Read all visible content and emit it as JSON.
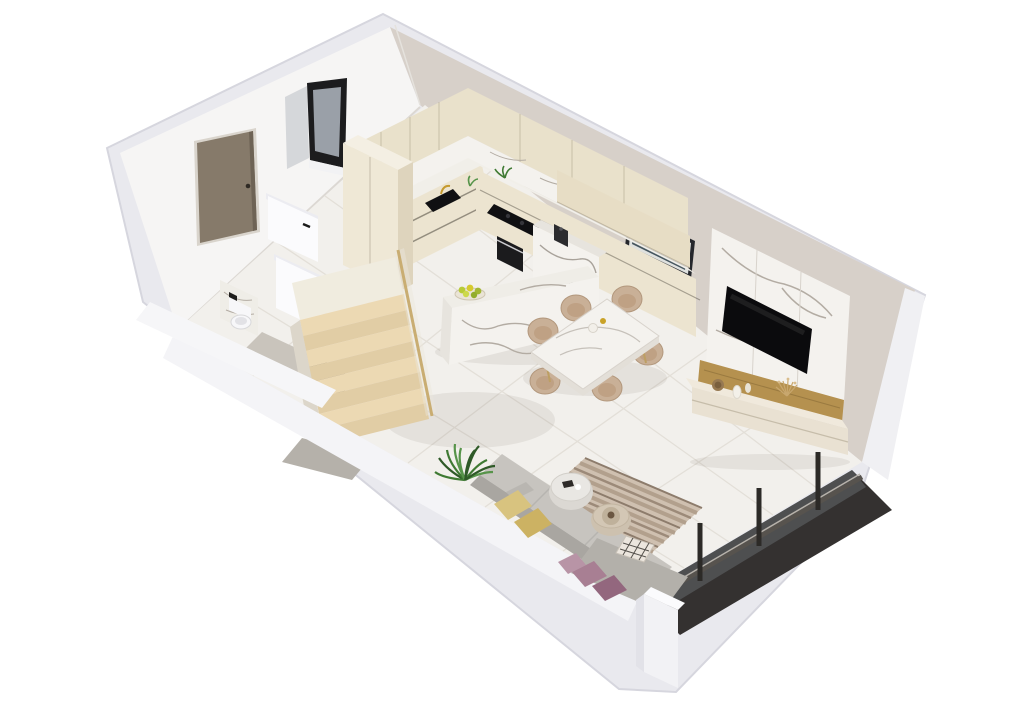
{
  "scene": {
    "kind": "isometric-3d-floor-plan-render",
    "background": "#ffffff",
    "rooms": [
      "entry-hall",
      "bathroom",
      "staircase",
      "kitchen",
      "dining-area",
      "living-room",
      "balcony"
    ],
    "objects": [
      "entry-door",
      "window",
      "framed-artwork",
      "kitchen-upper-cabinets",
      "kitchen-base-cabinets",
      "tall-cabinet-column",
      "marble-backsplash",
      "kitchen-sink",
      "gold-faucet",
      "cooktop",
      "built-in-oven",
      "coffee-machine",
      "marble-island",
      "fruit-bowl",
      "marble-column",
      "dining-table",
      "dining-chairs",
      "tv-marble-panel",
      "wall-mounted-tv",
      "wood-accent-strip",
      "media-console",
      "decor-vases",
      "dried-flowers",
      "round-wicker-decor",
      "toilet",
      "partition-walls",
      "wooden-staircase",
      "stair-gold-handrail",
      "under-stair-niche",
      "gray-mat",
      "corner-sofa",
      "yellow-cushions",
      "mauve-cushions",
      "striped-rug",
      "marble-pouf",
      "beige-pouf",
      "plaid-throw",
      "potted-plant",
      "glass-balcony-wall",
      "balcony-dark-floor",
      "side-table"
    ],
    "counts": {
      "dining_chairs": 6,
      "stair_treads": 8,
      "glass_wall_posts": 3
    },
    "colors": {
      "outer_wall": "#e9e9ee",
      "outer_wall_edge": "#d6d6de",
      "wall_top": "#f4f4f7",
      "ledge": "#f6f6f8",
      "wall_left_inner": "#f6f5f4",
      "wall_right_inner": "#d7d0c9",
      "wall_right_wedge": "#f0f0f3",
      "floor": "#f2f0ec",
      "tile_line": "#e3dfd8",
      "cabinet": "#ece4d0",
      "cabinet_upper": "#e9e1cb",
      "cabinet_hood": "#e7ddc5",
      "cabinet_side": "#ded4bd",
      "cabinet_front": "#efe8d6",
      "counter": "#f1efe9",
      "marble": "#f4f2ee",
      "marble_mid": "#efede7",
      "marble_shade": "#e7e4de",
      "vein": "#b3aca3",
      "appliance_black": "#101012",
      "oven_black": "#1b1b1d",
      "wood_stair": "#ecd9b3",
      "wood_stair_alt": "#e1cda5",
      "landing": "#f0ecdf",
      "stair_rail": "#c9ad72",
      "stair_side": "#dcd6ca",
      "under_stair": "#8f8a81",
      "door": "#867a6a",
      "door_frame": "#d9d4cc",
      "window_frame": "#1c1c1e",
      "window_glass": "#9aa0a8",
      "window_panel": "#d5d7da",
      "art_frame": "#25272c",
      "art_image": "#46565f",
      "tv": "#0b0b0d",
      "wood_accent": "#b5914f",
      "console": "#e9e1d2",
      "console_top": "#f0e9dc",
      "sofa_seat": "#c7c4bf",
      "sofa_back": "#a9a6a1",
      "sofa_chaise": "#b3b0aa",
      "pillow_yellow": "#d8c37f",
      "pillow_yellow2": "#ccb263",
      "pillow_mauve": "#a87f93",
      "pillow_mauve2": "#93677e",
      "rug_base": "#cfc0b0",
      "rug_stripe": "#b2a08d",
      "rug_stripe_dark": "#8d7c6c",
      "pouf_marble": "#e9e7e3",
      "pouf_marble_side": "#dbd8d3",
      "pouf_beige": "#d3c7b5",
      "pouf_beige_side": "#cdc1af",
      "plaid": "#ece6de",
      "plant": "#3f7a33",
      "plant_dark": "#2f5a28",
      "plant_light": "#57944a",
      "glass_dark": "#4b4c4e",
      "glass_tint": "rgba(120,128,135,0.38)",
      "balcony_floor": "#343130",
      "frame_dark": "#2c2a27",
      "chair": "#c9b097",
      "chair_shade": "#b2977c",
      "chair_inner": "#bfa184",
      "toilet": "#f7f7f9",
      "partition": "#fbfbfd",
      "partition_top": "#ececf1",
      "mat_gray": "#b5b1aa",
      "bath_floor": "#c9c4bc",
      "gold": "#c59a2e",
      "shadow": "rgba(60,50,40,0.08)"
    }
  }
}
